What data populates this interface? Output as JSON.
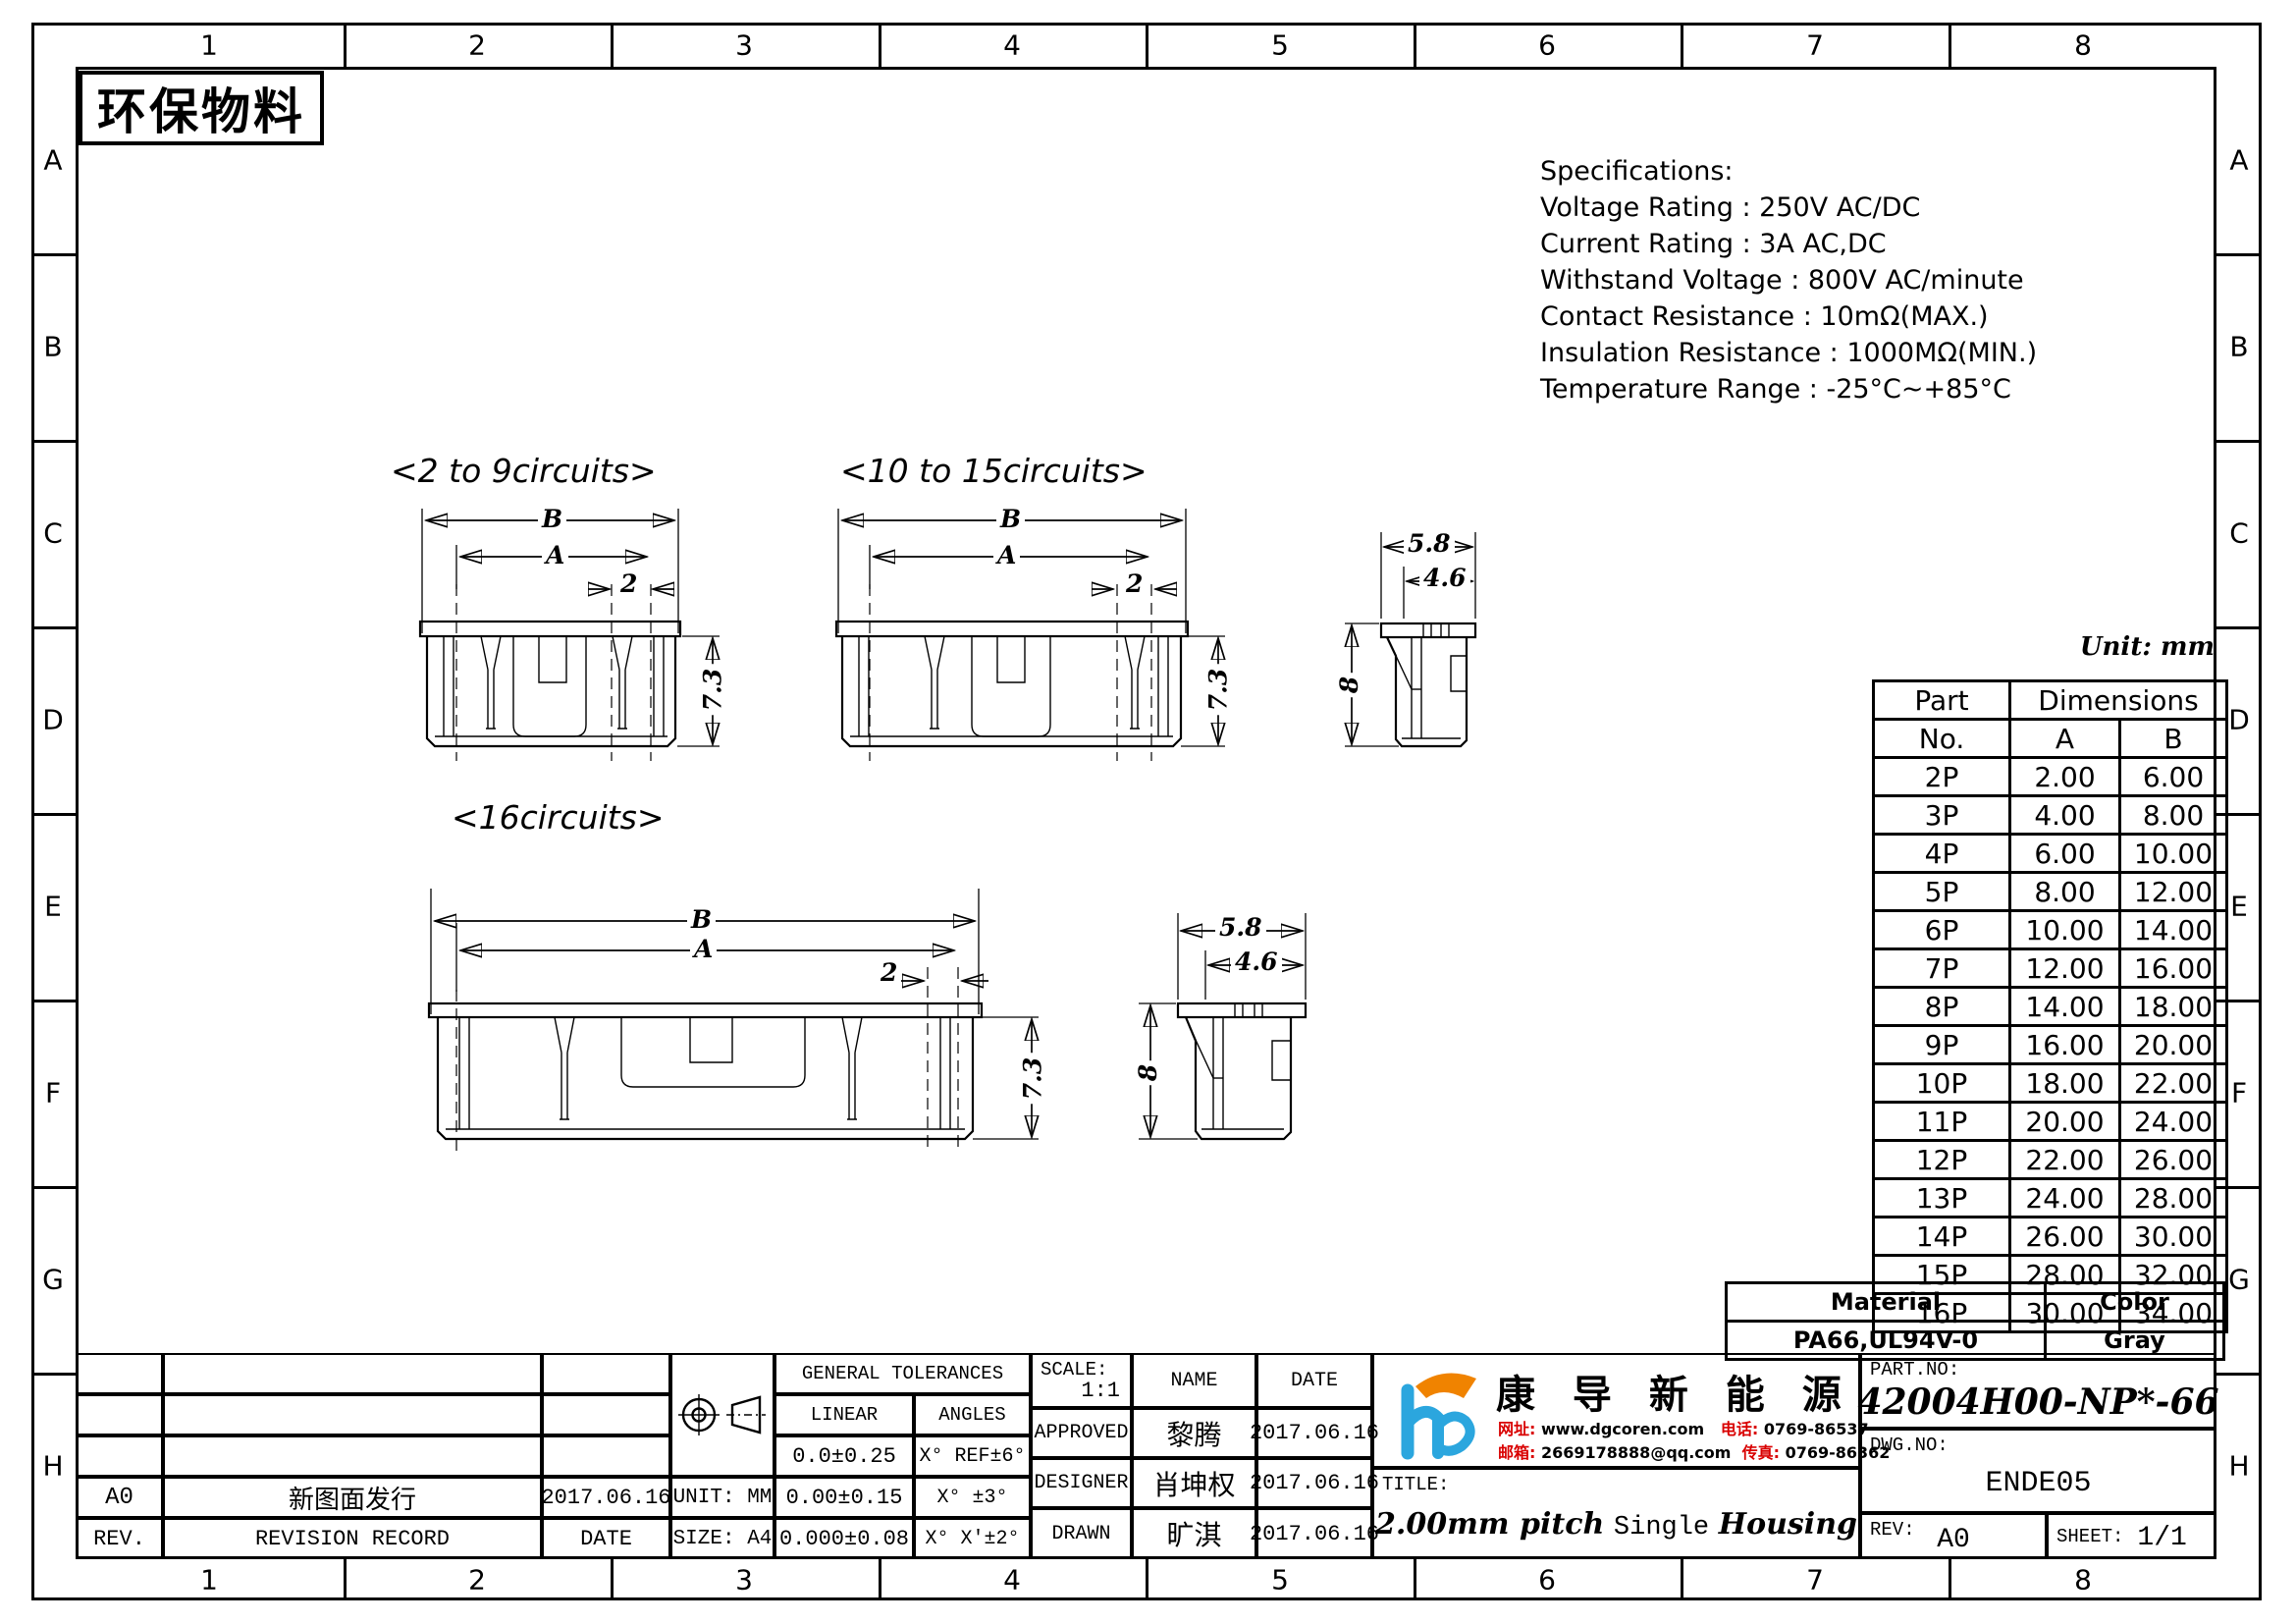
{
  "stamp": "环保物料",
  "unit_note": "Unit: mm",
  "border": {
    "cols": [
      "1",
      "2",
      "3",
      "4",
      "5",
      "6",
      "7",
      "8"
    ],
    "rows": [
      "A",
      "B",
      "C",
      "D",
      "E",
      "F",
      "G",
      "H"
    ]
  },
  "specs": {
    "title": "Specifications:",
    "lines": [
      "Voltage Rating : 250V AC/DC",
      "Current Rating : 3A AC,DC",
      "Withstand Voltage : 800V AC/minute",
      "Contact Resistance : 10mΩ(MAX.)",
      "Insulation Resistance : 1000MΩ(MIN.)",
      "Temperature Range : -25°C~+85°C"
    ]
  },
  "views": {
    "v1_label": "<2 to 9circuits>",
    "v2_label": "<10 to 15circuits>",
    "v3_label": "<16circuits>"
  },
  "dims": {
    "A": "A",
    "B": "B",
    "pitch": "2",
    "height": "7.3",
    "side_height": "8",
    "depth_outer": "5.8",
    "depth_inner": "4.6"
  },
  "part_table": {
    "h_part": "Part",
    "h_no": "No.",
    "h_dimensions": "Dimensions",
    "h_a": "A",
    "h_b": "B",
    "rows": [
      [
        "2P",
        "2.00",
        "6.00"
      ],
      [
        "3P",
        "4.00",
        "8.00"
      ],
      [
        "4P",
        "6.00",
        "10.00"
      ],
      [
        "5P",
        "8.00",
        "12.00"
      ],
      [
        "6P",
        "10.00",
        "14.00"
      ],
      [
        "7P",
        "12.00",
        "16.00"
      ],
      [
        "8P",
        "14.00",
        "18.00"
      ],
      [
        "9P",
        "16.00",
        "20.00"
      ],
      [
        "10P",
        "18.00",
        "22.00"
      ],
      [
        "11P",
        "20.00",
        "24.00"
      ],
      [
        "12P",
        "22.00",
        "26.00"
      ],
      [
        "13P",
        "24.00",
        "28.00"
      ],
      [
        "14P",
        "26.00",
        "30.00"
      ],
      [
        "15P",
        "28.00",
        "32.00"
      ],
      [
        "16P",
        "30.00",
        "34.00"
      ]
    ]
  },
  "material_table": {
    "h_material": "Material",
    "h_color": "Color",
    "material": "PA66,UL94V-0",
    "color": "Gray"
  },
  "revisions": {
    "r4": [
      "A0",
      "新图面发行",
      "2017.06.16"
    ],
    "r5": [
      "REV.",
      "REVISION RECORD",
      "DATE"
    ]
  },
  "tolerances": {
    "title": "GENERAL TOLERANCES",
    "h_linear": "LINEAR",
    "h_angles": "ANGLES",
    "rows": [
      [
        "0.0±0.25",
        "X° REF±6°"
      ],
      [
        "0.00±0.15",
        "X° ±3°"
      ],
      [
        "0.000±0.08",
        "X° X'±2°"
      ]
    ]
  },
  "info": {
    "unit": "UNIT: MM",
    "size": "SIZE: A4",
    "scale_label": "SCALE:",
    "scale": "1:1",
    "h_name": "NAME",
    "h_date": "DATE",
    "approved_label": "APPROVED",
    "approved_name": "黎腾",
    "approved_date": "2017.06.16",
    "designer_label": "DESIGNER",
    "designer_name": "肖坤权",
    "designer_date": "2017.06.16",
    "drawn_label": "DRAWN",
    "drawn_name": "旷淇",
    "drawn_date": "2017.06.16"
  },
  "company": {
    "name": "康 导 新 能 源",
    "web_label": "网址:",
    "web": "www.dgcoren.com",
    "tel_label": "电话:",
    "tel": "0769-86537",
    "mail_label": "邮箱:",
    "mail": "2669178888@qq.com",
    "fax_label": "传真:",
    "fax": "0769-86362"
  },
  "titleblock": {
    "title_label": "TITLE:",
    "title_1": "2.00mm pitch",
    "title_2": "Single",
    "title_3": "Housing",
    "partno_label": "PART.NO:",
    "partno": "42004H00-NP*-66",
    "dwg_label": "DWG.NO:",
    "dwg": "ENDE05",
    "rev_label": "REV:",
    "rev": "A0",
    "sheet_label": "SHEET:",
    "sheet": "1/1"
  },
  "colors": {
    "logo_blue": "#2BA6DE",
    "logo_orange": "#F08300",
    "accent_red": "#D90000"
  }
}
